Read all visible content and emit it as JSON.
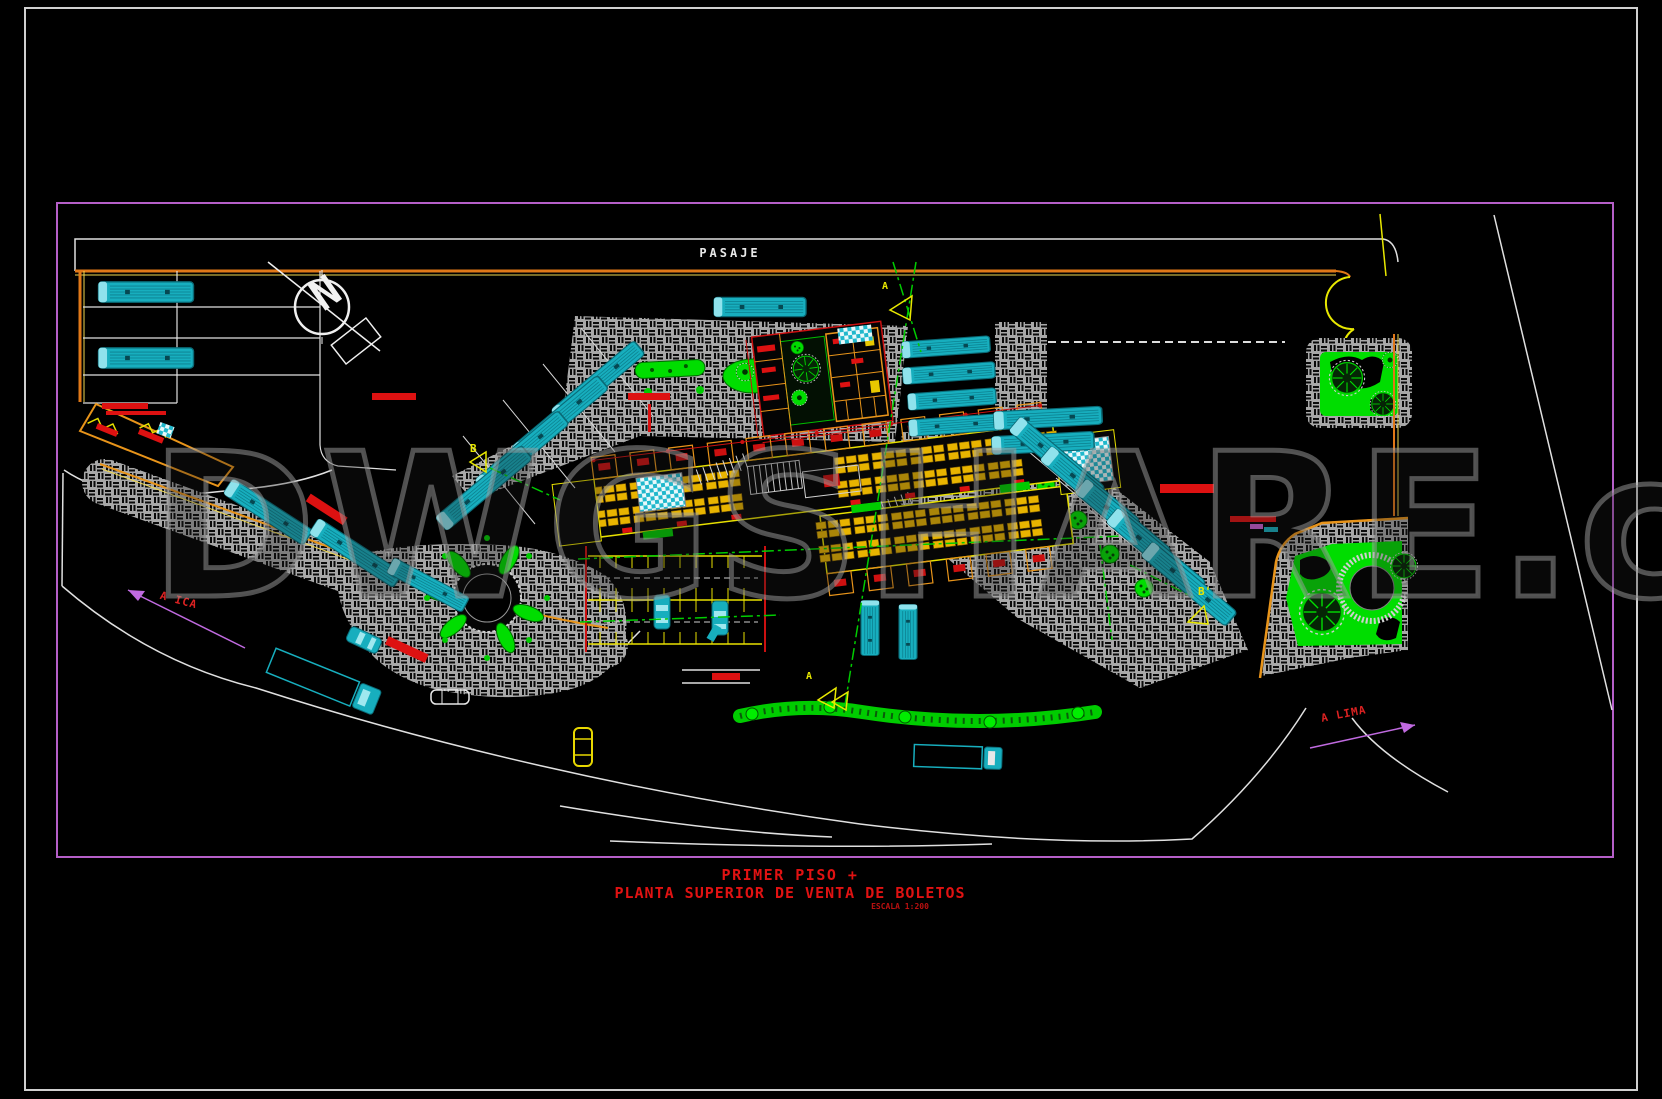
{
  "plan": {
    "street_label": "PASAJE",
    "north_label": "N",
    "watermark_text": "DWGSHARE.c",
    "route_labels": {
      "west": "A ICA",
      "east": "A LIMA"
    },
    "section_markers": {
      "top": "A",
      "bottom": "A",
      "left": "B",
      "right": "B'"
    },
    "title_block": {
      "line1": "PRIMER PISO +",
      "line2": "PLANTA SUPERIOR DE VENTA DE BOLETOS",
      "scale_note": "ESCALA 1:200"
    },
    "colors": {
      "background": "#000000",
      "outer_frame": "#d0d0d0",
      "inner_frame": "#b55fc8",
      "road_white": "#e0e0e0",
      "curb_orange": "#e07818",
      "curb_yellow": "#f0d850",
      "wall_yellow": "#e8e000",
      "wall_orange": "#e8941a",
      "accent_red": "#dd1111",
      "vegetation_green": "#00dd00",
      "vehicle_cyan": "#17aebe",
      "hatch_gray": "#a8a8a8",
      "arrow_magenta": "#c06ae0",
      "watermark_gray": "#a0a0a0"
    }
  }
}
